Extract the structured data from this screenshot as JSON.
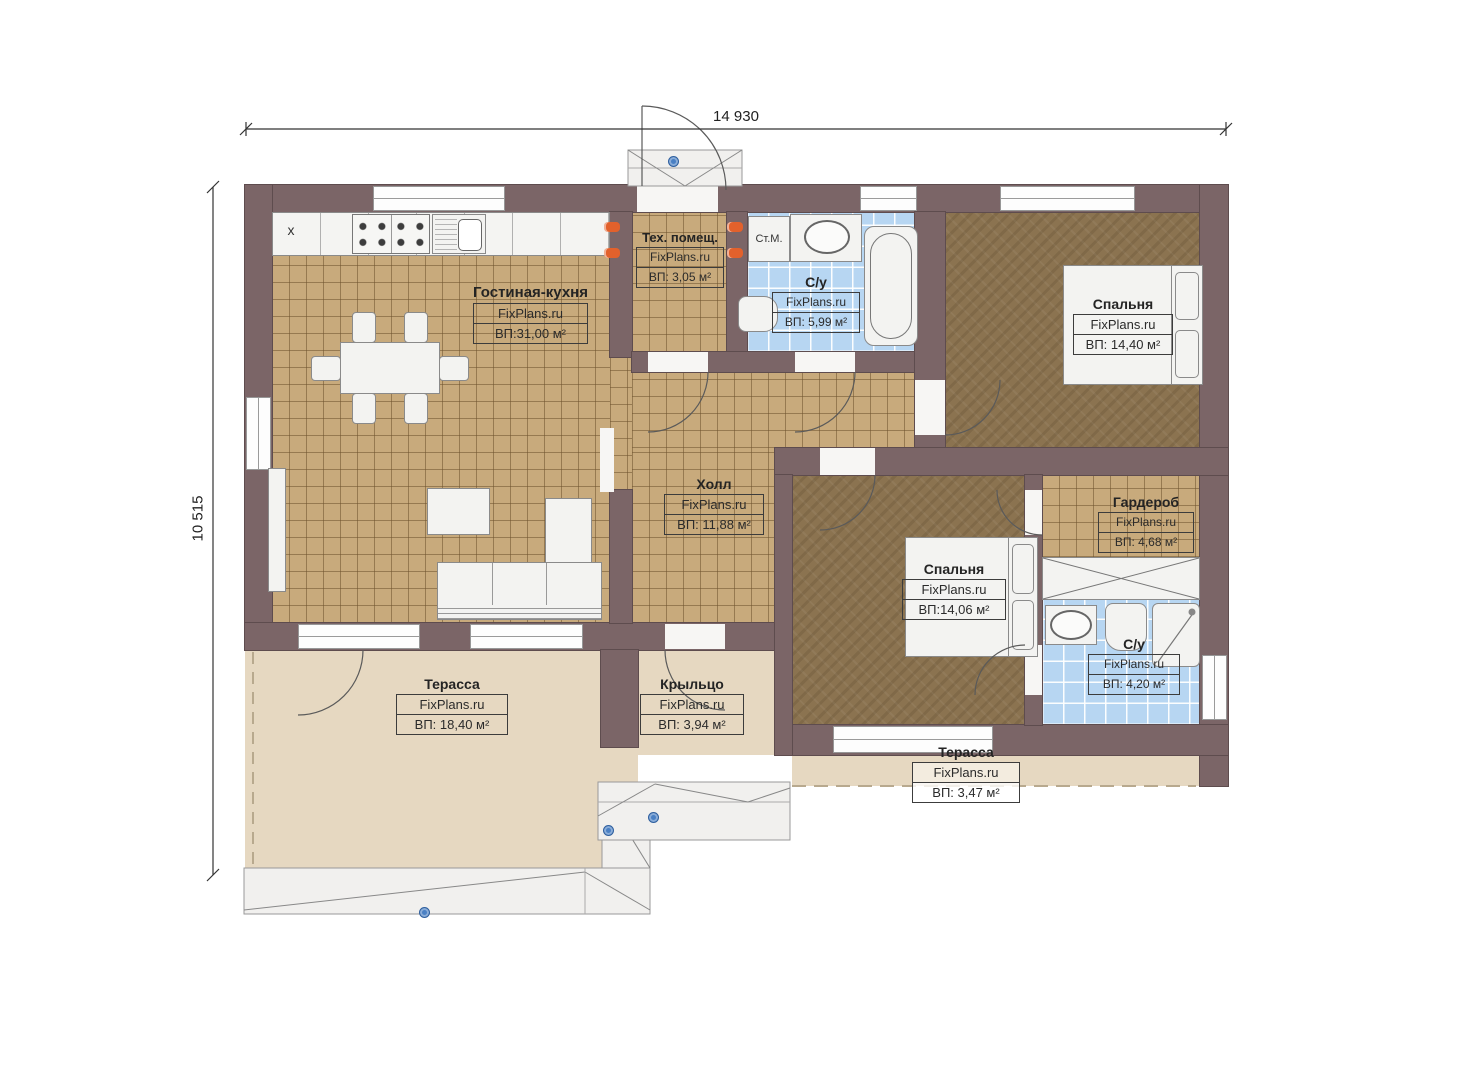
{
  "dimensions": {
    "width": "14 930",
    "height": "10 515"
  },
  "brand": "FixPlans.ru",
  "rooms": [
    {
      "id": "living",
      "name": "Гостиная-кухня",
      "area": "ВП:31,00 м²"
    },
    {
      "id": "tech",
      "name": "Тех. помещ.",
      "area": "ВП: 3,05 м²"
    },
    {
      "id": "bath1",
      "name": "С/у",
      "area": "ВП: 5,99 м²"
    },
    {
      "id": "bed1",
      "name": "Спальня",
      "area": "ВП: 14,40 м²"
    },
    {
      "id": "hall",
      "name": "Холл",
      "area": "ВП: 11,88 м²"
    },
    {
      "id": "wardrobe",
      "name": "Гардероб",
      "area": "ВП: 4,68 м²"
    },
    {
      "id": "bed2",
      "name": "Спальня",
      "area": "ВП:14,06 м²"
    },
    {
      "id": "bath2",
      "name": "С/у",
      "area": "ВП: 4,20 м²"
    },
    {
      "id": "terrace1",
      "name": "Терасса",
      "area": "ВП: 18,40 м²"
    },
    {
      "id": "porch",
      "name": "Крыльцо",
      "area": "ВП: 3,94 м²"
    },
    {
      "id": "terrace2",
      "name": "Терасса",
      "area": "ВП: 3,47 м²"
    }
  ],
  "fixtures": {
    "washing_machine": "Ст.М.",
    "fridge_marker": "x"
  },
  "colors": {
    "wall": "#7b6567",
    "floor_tile_tan": "#c8aa7c",
    "floor_wood_dark": "#8b7350",
    "floor_bath_blue": "#b7d6f2",
    "floor_terrace": "#e6d8c1",
    "socket_accent": "#e2612c",
    "marker_blue": "#4a80c4"
  }
}
